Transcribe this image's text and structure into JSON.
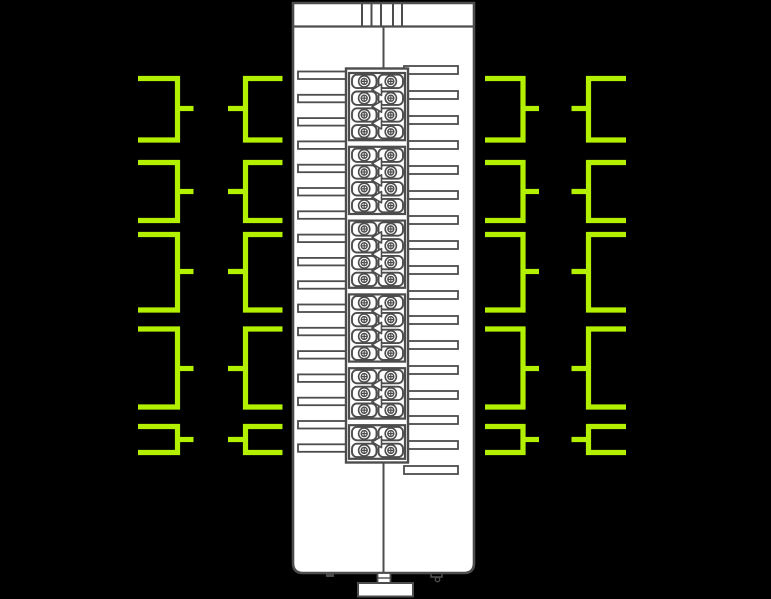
{
  "diagram": {
    "kind": "io-module-wiring-diagram",
    "canvas": {
      "width": 771,
      "height": 599
    },
    "colors": {
      "background": "#000000",
      "outline": "#4d4d4d",
      "fill": "#ffffff",
      "wire": "#b2f000"
    },
    "module": {
      "x": 293,
      "y": 3,
      "right": 474,
      "bottom": 573,
      "corner_radius": 10,
      "cap_line_y": 26.5,
      "cap_slot_xs": [
        362,
        371.5,
        381,
        393,
        402
      ],
      "center_line_x": 383.5,
      "center_line_top": {
        "y1": 26.5,
        "y2": 69
      },
      "center_line_bottom": {
        "y1": 462,
        "y2": 573
      },
      "din_clip": {
        "x": 358,
        "y": 583,
        "width": 55,
        "height": 13.5
      },
      "clip_stub": {
        "x": 377.5,
        "y": 573,
        "width": 13,
        "height": 10,
        "inner_line_y": 578
      },
      "foot_left": {
        "x": 326,
        "y": 573,
        "width": 8,
        "height": 4
      },
      "foot_right": {
        "x": 431,
        "y": 573,
        "width": 11,
        "height": 4
      },
      "foot_right_pin": {
        "cx": 437.5,
        "cy": 579.5,
        "r": 2.2
      }
    },
    "terminal_block": {
      "frame": {
        "x": 346,
        "y": 68.5,
        "width": 62,
        "height": 394
      },
      "group_x": 349,
      "group_width": 56,
      "start_y": 73,
      "row_height": 16.8,
      "group_gap": 6.6,
      "groups_rows": [
        4,
        4,
        4,
        4,
        3,
        2
      ],
      "cell": {
        "left_x": 352,
        "right_x": 378.5,
        "width": 24.5,
        "inset_y": 1.7,
        "radius": 5
      },
      "screw": {
        "left_cx": 364.2,
        "right_cx": 390.8,
        "outer_r": 5.6,
        "inner_r": 3,
        "cross": 2.4
      },
      "arrow": {
        "tip_x": 372,
        "back_x": 381.5,
        "half_h": 5.6
      }
    },
    "tabs": {
      "left": {
        "x": 298,
        "width": 52,
        "y0": 71.5,
        "dy": 23.3,
        "count": 17,
        "height": 7.5
      },
      "right": {
        "x": 404,
        "width": 54,
        "y0": 66,
        "dy": 25.0,
        "count": 17,
        "height": 8
      }
    },
    "wires": {
      "stroke_width": 5.2,
      "columns": [
        {
          "id": "left-outer",
          "vx": 177.5,
          "arm_dx": -39.5,
          "stub_dx": 16
        },
        {
          "id": "left-inner",
          "vx": 245.5,
          "arm_dx": 37,
          "stub_dx": -17.5
        },
        {
          "id": "right-inner",
          "vx": 523,
          "arm_dx": -38,
          "stub_dx": 16
        },
        {
          "id": "right-outer",
          "vx": 588.5,
          "arm_dx": 37.5,
          "stub_dx": -17
        }
      ],
      "brackets": [
        {
          "top": 78.5,
          "stub": 108.5,
          "bottom": 140
        },
        {
          "top": 162.5,
          "stub": 191.5,
          "bottom": 220.5
        },
        {
          "top": 234.5,
          "stub": 271.5,
          "bottom": 310
        },
        {
          "top": 329,
          "stub": 368.5,
          "bottom": 407
        },
        {
          "top": 426.5,
          "stub": 439.5,
          "bottom": 452.5
        }
      ]
    }
  }
}
